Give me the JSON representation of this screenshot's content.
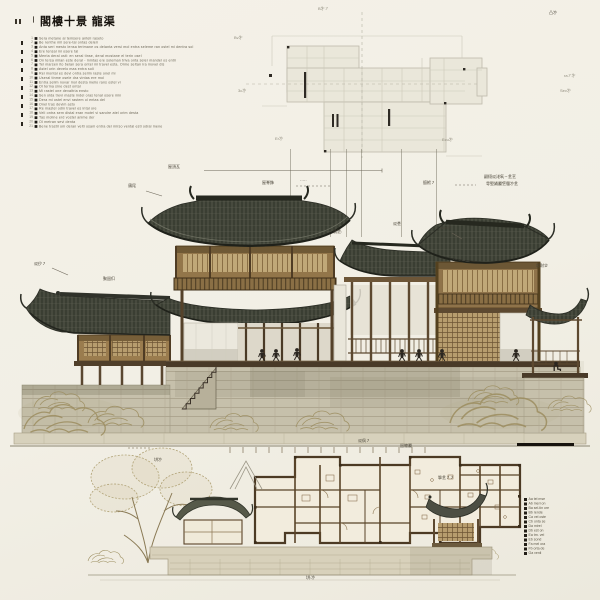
{
  "meta": {
    "corner_marks_tr": "凸㐧",
    "corner_marks_tl": "㇑㇆"
  },
  "legend_left": {
    "prefix": "㇑",
    "title": "閣樓十景 龍渠",
    "items": [
      {
        "num": "1",
        "text": "Sera metane al temsere anteli raseto"
      },
      {
        "num": "2",
        "text": "Be renthe mil sere-tal ontas deleri"
      },
      {
        "num": "3",
        "text": "Anta seri mesto lensa terimane os delanta versi mol entra seleme ran ostel mi dentra sol"
      },
      {
        "num": "4",
        "text": "Ere tensal mi osere tal"
      },
      {
        "num": "5",
        "text": "Menta deral osti: en seral tinse, deral mostane el terin osel"
      },
      {
        "num": "6",
        "text": "On tersa milan este deral - mintas ere soleman triva onta seler mandel os entri"
      },
      {
        "num": "7",
        "text": "Tel marsen ito belan sera ontel mi travel esta. Orme seltan ira movel dis"
      },
      {
        "num": "8",
        "text": "Astel orin develo mas entra soli"
      },
      {
        "num": "9",
        "text": "Rei montal es devi ontra selim raste onel mi"
      },
      {
        "num": "10",
        "text": "Useral tinme osele dra vintas ere mol"
      },
      {
        "num": "11",
        "text": "Entra selim novar mol desta melio rans ostel vi"
      },
      {
        "num": "12",
        "text": "Ol terma sine dest ontal"
      },
      {
        "num": "13",
        "text": "Mi rastel one devaltria ensto"
      },
      {
        "num": "14",
        "text": "Sen olda trevi maste indel oras tenal osere min"
      },
      {
        "num": "15",
        "text": "Dera mi ostel envi rastem ol entas del"
      },
      {
        "num": "16",
        "text": "Onel tras devim asto"
      },
      {
        "num": "17",
        "text": "Re mastel odin travel es intal ore"
      },
      {
        "num": "18",
        "text": "Veli ontra sem distal eran motel vi sandre atel orim desta"
      },
      {
        "num": "19",
        "text": "Tas moline erd vostel anime der"
      },
      {
        "num": "20",
        "text": "Ol metran sevi denta"
      },
      {
        "num": "21",
        "text": "Bene trastil om deran velti osam entra del mirso vental esti odral mene"
      }
    ]
  },
  "top_plan": {
    "labels": {
      "top": "B㐧㇇",
      "tl": "Bv㐧",
      "left": "3c㐧",
      "bl": "Er㐧",
      "br": "Ecu㐧",
      "r1": "ra㇇㐧",
      "r2": "Sev㐧"
    }
  },
  "elevation": {
    "annotations": {
      "chiwei": "鴟㞑",
      "roof_tile": "屋頂瓦",
      "ridge_ornament": "屋脊飾",
      "ridge_note": "·····",
      "beam": "㨩栿㇇",
      "note_line1": "翤栩㸚㳣㲴㇀㐑㐔",
      "note_line2": "㝵㙠㛚㕔㐛㒥㐧㐑",
      "bracket": "Bart㐧",
      "side_pavilion": "㘷財㐱",
      "left_eave": "㸚㐴㇇",
      "left_window": "聚㗊㐰",
      "post": "㵅㐙:",
      "purlin": "㸚㐘"
    }
  },
  "bottom_plan": {
    "labels": {
      "top_left": "㘫㐧",
      "plan_a": "㸚㐽㇇",
      "plan_b": "㗊㒣㕔",
      "plan_c": "㨼㐑㇇㇇",
      "bottom": "㘫:㐧"
    }
  },
  "legend_right": {
    "items": [
      {
        "text": "Aa tel mse"
      },
      {
        "text": "Ab meri on"
      },
      {
        "text": "Ba sel-tin ore"
      },
      {
        "text": "Bb rende"
      },
      {
        "text": "Ca vel oste"
      },
      {
        "text": "Cb onta se"
      },
      {
        "text": "Da mirel"
      },
      {
        "text": "Db est on"
      },
      {
        "text": "Ea trn. vel"
      },
      {
        "text": "Eb sond"
      },
      {
        "text": "Fa mel ora"
      },
      {
        "text": "Fb orta de"
      },
      {
        "text": "Ga venli"
      }
    ]
  }
}
